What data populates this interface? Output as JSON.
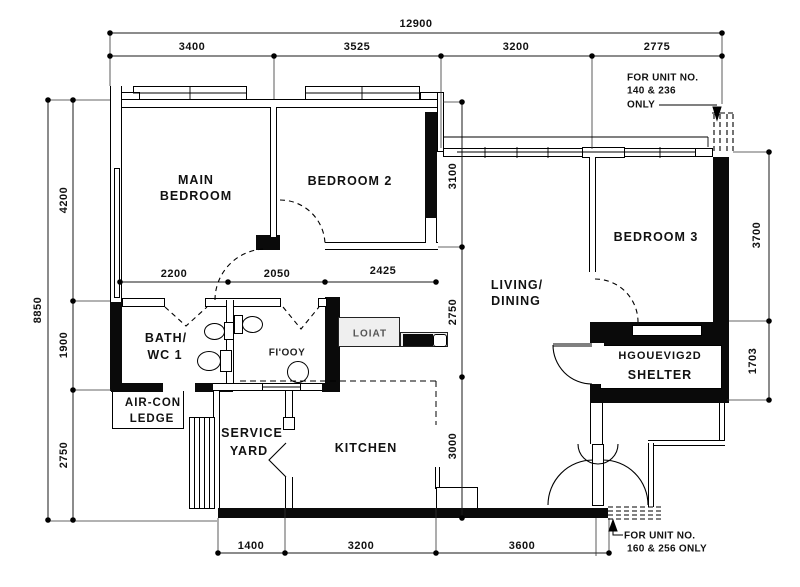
{
  "dims": {
    "top": {
      "overall": "12900",
      "segments": [
        "3400",
        "3525",
        "3200",
        "2775"
      ]
    },
    "left": {
      "overall": "8850",
      "segments": [
        "4200",
        "1900",
        "2750"
      ]
    },
    "right": {
      "segments": [
        "3700",
        "1703"
      ]
    },
    "inner_row": {
      "segments": [
        "2200",
        "2050",
        "2425"
      ]
    },
    "inner_col": {
      "segments": [
        "3100",
        "2750",
        "3000"
      ]
    },
    "bottom": {
      "segments": [
        "1400",
        "3200",
        "3600"
      ]
    }
  },
  "rooms": {
    "main_bedroom": [
      "MAIN",
      "BEDROOM"
    ],
    "bedroom2": "BEDROOM 2",
    "bedroom3": "BEDROOM 3",
    "living": [
      "LIVING/",
      "DINING"
    ],
    "bath1": [
      "BATH/",
      "WC 1"
    ],
    "bath2_label": "FI'OOY",
    "aircon": [
      "AIR-CON",
      "LEDGE"
    ],
    "service_yard": [
      "SERVICE",
      "YARD"
    ],
    "kitchen": "KITCHEN",
    "shelter": [
      "HGOUEVIG2D",
      "SHELTER"
    ],
    "counter_tag": "LOIAT"
  },
  "notes": {
    "top": [
      "FOR  UNIT NO.",
      "140 & 236",
      "ONLY"
    ],
    "bottom": [
      "FOR  UNIT NO.",
      "160 & 256 ONLY"
    ]
  }
}
